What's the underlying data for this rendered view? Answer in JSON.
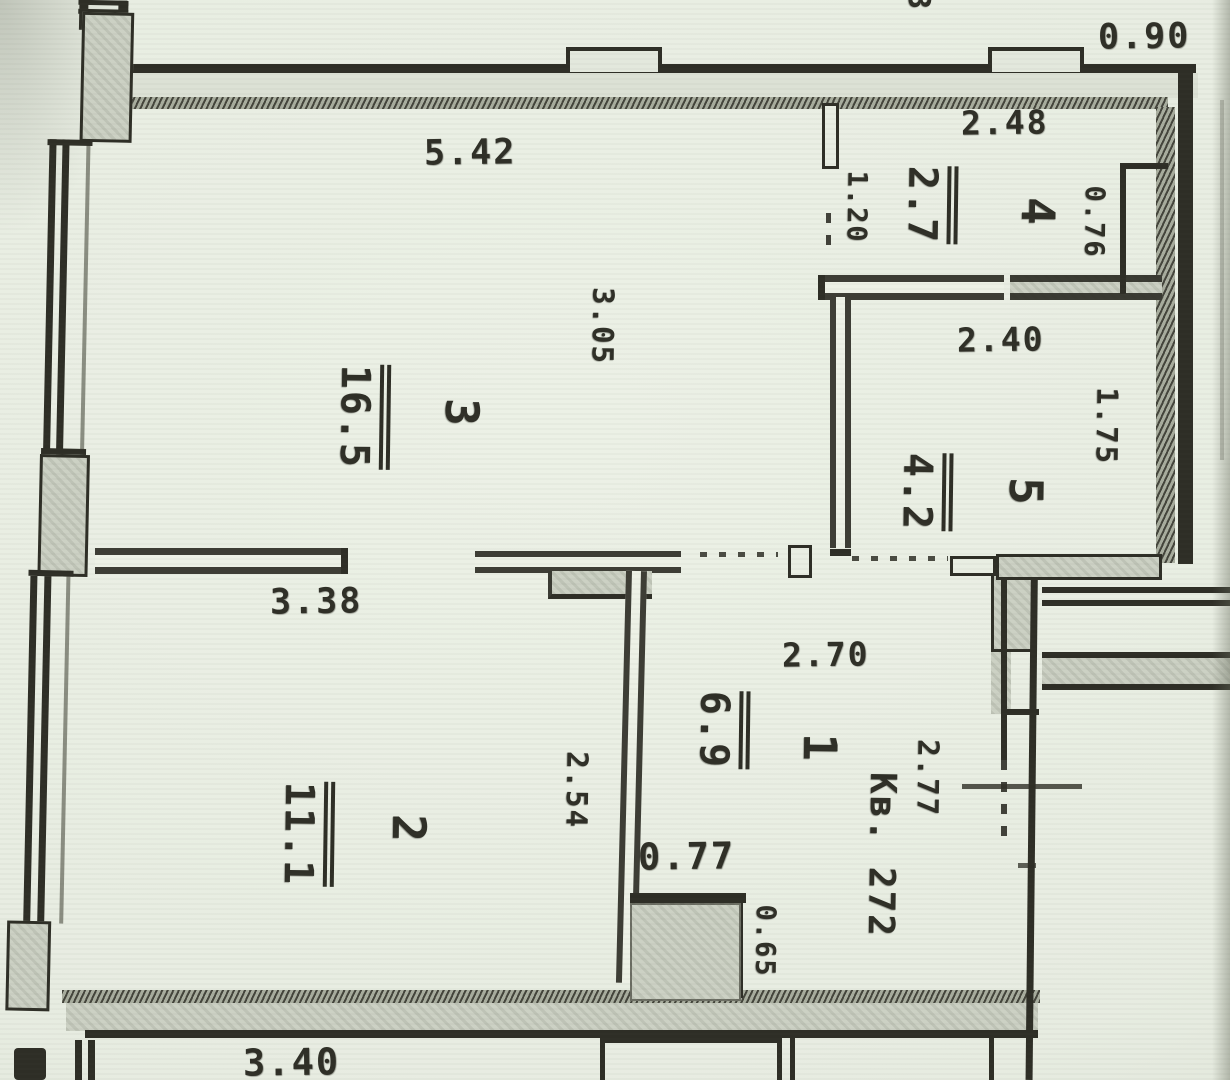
{
  "plan": {
    "apartment_label": "Кв. 272",
    "rooms": [
      {
        "number": "1",
        "area": "6.9"
      },
      {
        "number": "2",
        "area": "11.1"
      },
      {
        "number": "3",
        "area": "16.5"
      },
      {
        "number": "4",
        "area": "2.7"
      },
      {
        "number": "5",
        "area": "4.2"
      }
    ],
    "dimensions": {
      "d542": "5.42",
      "d090": "0.90",
      "d248": "2.48",
      "d120": "1.20",
      "d076": "0.76",
      "d305": "3.05",
      "d240": "2.40",
      "d175": "1.75",
      "d338": "3.38",
      "d254": "2.54",
      "d270": "2.70",
      "d277": "2.77",
      "d077": "0.77",
      "d065": "0.65",
      "d340": "3.40",
      "fragment": "3"
    },
    "colors": {
      "paper": "#e7ece1",
      "ink": "#2e2e26",
      "wall_fill": "#ccd1c4",
      "hatch": "#a8ad9e"
    }
  }
}
